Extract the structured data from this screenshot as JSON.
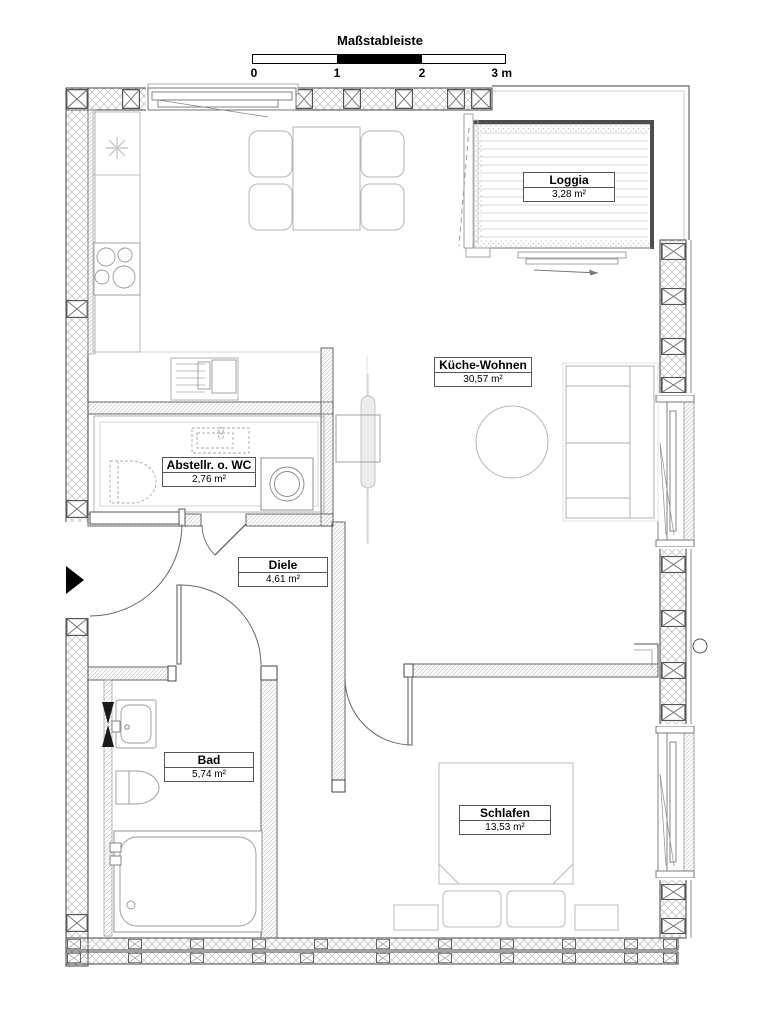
{
  "meta": {
    "drawing_type": "apartment floor plan",
    "language": "de"
  },
  "scale_bar": {
    "title": "Maßstableiste",
    "ticks": [
      "0",
      "1",
      "2",
      "3 m"
    ],
    "length_m": 3,
    "segment_colors": [
      "#ffffff",
      "#000000",
      "#ffffff"
    ]
  },
  "rooms": [
    {
      "name": "Loggia",
      "area": "3,28 m²"
    },
    {
      "name": "Küche-Wohnen",
      "area": "30,57 m²"
    },
    {
      "name": "Abstellr. o. WC",
      "area": "2,76 m²"
    },
    {
      "name": "Diele",
      "area": "4,61 m²"
    },
    {
      "name": "Bad",
      "area": "5,74 m²"
    },
    {
      "name": "Schlafen",
      "area": "13,53 m²"
    }
  ],
  "fixtures": [
    "dining-table",
    "chair",
    "kitchen-counter",
    "stove",
    "kitchen-sink",
    "round-table",
    "sofa",
    "radiator",
    "washing-machine",
    "toilet",
    "hand-basin",
    "bathtub",
    "double-bed",
    "pillow",
    "nightstand",
    "entrance-arrow",
    "door-swing",
    "window",
    "loggia-decking"
  ],
  "colors": {
    "background": "#ffffff",
    "wall_line": "#444444",
    "insulation_hatch": "#c4c4c4",
    "furniture_line": "#b0b0b0",
    "loggia_edge": "#4d4d4d",
    "entrance_arrow": "#000000"
  }
}
